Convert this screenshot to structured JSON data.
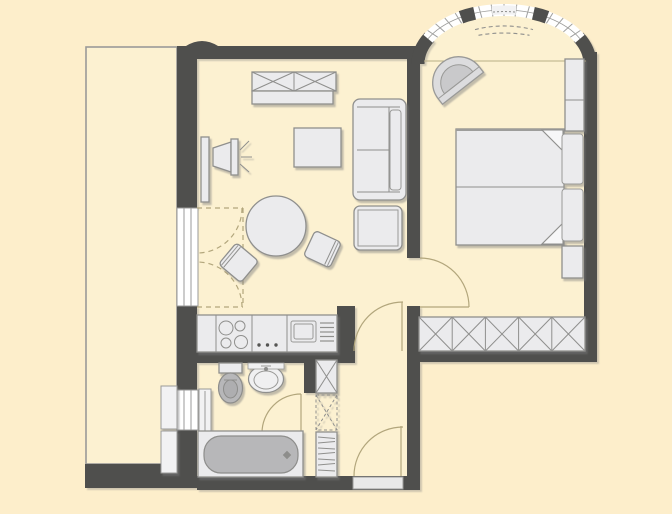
{
  "document": {
    "kind": "apartment-floor-plan",
    "description": "Top-down architectural floor plan of a one-bedroom apartment with balcony, open living/dining room with kitchenette, bathroom, entrance hall and bedroom with curved bay window",
    "visible_text": []
  },
  "palette": {
    "background": "#fdeecb",
    "floor": "#fcf1d1",
    "wall": "#4f4f4d",
    "furniture_fill": "#ebebed",
    "furniture_stroke": "#8f8f8d",
    "fixture_gray": "#b7b7b9",
    "window_glass": "#ffffff",
    "door_swing": "#b2a67c"
  },
  "rooms": [
    {
      "id": "balcony",
      "label": "Balcony",
      "contents": [
        "storage-unit-upper",
        "storage-unit-lower"
      ]
    },
    {
      "id": "living-dining-room",
      "label": "Living / dining room",
      "contents": [
        "sideboard-x-front",
        "tv-on-stand",
        "coffee-table",
        "two-seat-sofa",
        "ottoman-side-table",
        "round-dining-table",
        "dining-chair-left",
        "dining-chair-right",
        "french-door-to-balcony"
      ]
    },
    {
      "id": "kitchenette",
      "label": "Open kitchenette",
      "contents": [
        "counter",
        "cooktop-4-burners",
        "control-knobs",
        "sink-with-drainboard"
      ]
    },
    {
      "id": "bathroom",
      "label": "Bathroom",
      "contents": [
        "toilet",
        "washbasin",
        "bathtub",
        "radiator",
        "window"
      ]
    },
    {
      "id": "hallway",
      "label": "Entrance hall",
      "contents": [
        "entrance-door",
        "tall-cabinet-3-sections",
        "door-to-living-room",
        "door-to-bathroom"
      ]
    },
    {
      "id": "bedroom",
      "label": "Bedroom",
      "contents": [
        "double-bed-two-mattresses",
        "pillows",
        "folded-blanket-corners",
        "nightstand-top",
        "nightstand-bottom",
        "half-round-armchair",
        "built-in-wardrobe-5-sections",
        "bay-window-with-radiator",
        "door-to-hall"
      ]
    }
  ],
  "openings": {
    "windows": [
      "balcony-french-window",
      "bathroom-window",
      "curved-bay-window"
    ],
    "doors": [
      "entrance-door",
      "living-room-door",
      "bedroom-door",
      "bathroom-door",
      "balcony-french-door-swing"
    ]
  }
}
